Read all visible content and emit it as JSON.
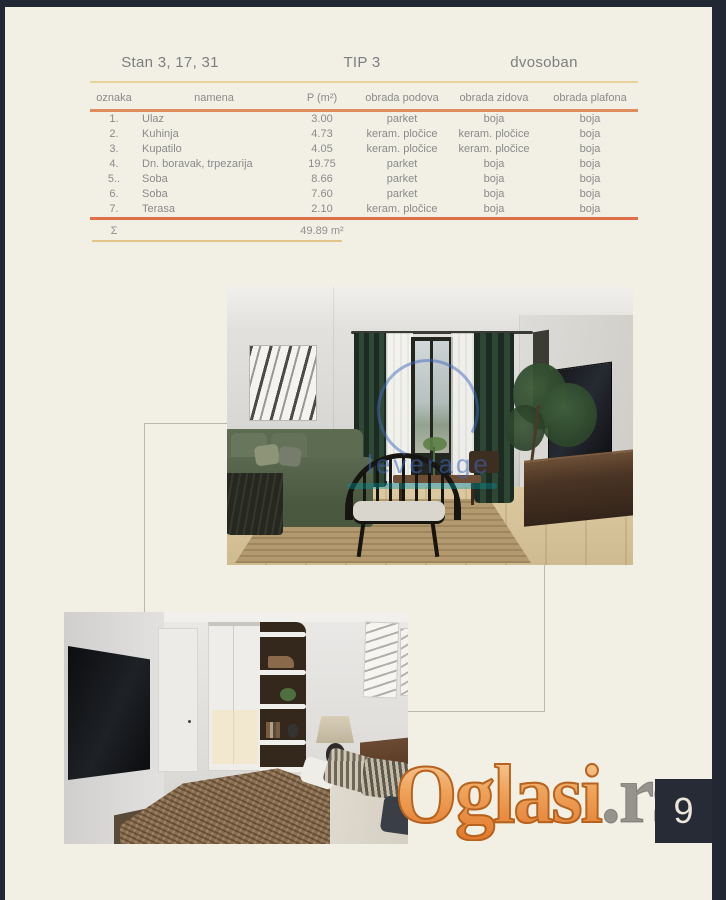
{
  "page": {
    "background": "#f2efe4",
    "frame_color": "#222734",
    "number": "9"
  },
  "table": {
    "title_left": "Stan 3, 17, 31",
    "title_center": "TIP 3",
    "title_right": "dvosoban",
    "columns": [
      "oznaka",
      "namena",
      "P (m²)",
      "obrada podova",
      "obrada zidova",
      "obrada plafona"
    ],
    "rows": [
      [
        "1.",
        "Ulaz",
        "3.00",
        "parket",
        "boja",
        "boja"
      ],
      [
        "2.",
        "Kuhinja",
        "4.73",
        "keram. pločice",
        "keram. pločice",
        "boja"
      ],
      [
        "3.",
        "Kupatilo",
        "4.05",
        "keram. pločice",
        "keram. pločice",
        "boja"
      ],
      [
        "4.",
        "Dn. boravak, trpezarija",
        "19.75",
        "parket",
        "boja",
        "boja"
      ],
      [
        "5..",
        "Soba",
        "8.66",
        "parket",
        "boja",
        "boja"
      ],
      [
        "6.",
        "Soba",
        "7.60",
        "parket",
        "boja",
        "boja"
      ],
      [
        "7.",
        "Terasa",
        "2.10",
        "keram. pločice",
        "boja",
        "boja"
      ]
    ],
    "sum": {
      "symbol": "Σ",
      "value": "49.89 m²"
    },
    "rule_gold": "#e9d19c",
    "rule_orange": "#e08d5e",
    "text_color": "#898b8c"
  },
  "photos": {
    "living_room": {
      "description": "living room render",
      "watermark_text": "leverage"
    },
    "bedroom": {
      "description": "bedroom render"
    }
  },
  "watermark": {
    "brand": "Oglasi",
    "suffix": ".rs",
    "gradient_top": "#f8d5a8",
    "gradient_bottom": "#e2782a",
    "outline": "#b5631f"
  }
}
